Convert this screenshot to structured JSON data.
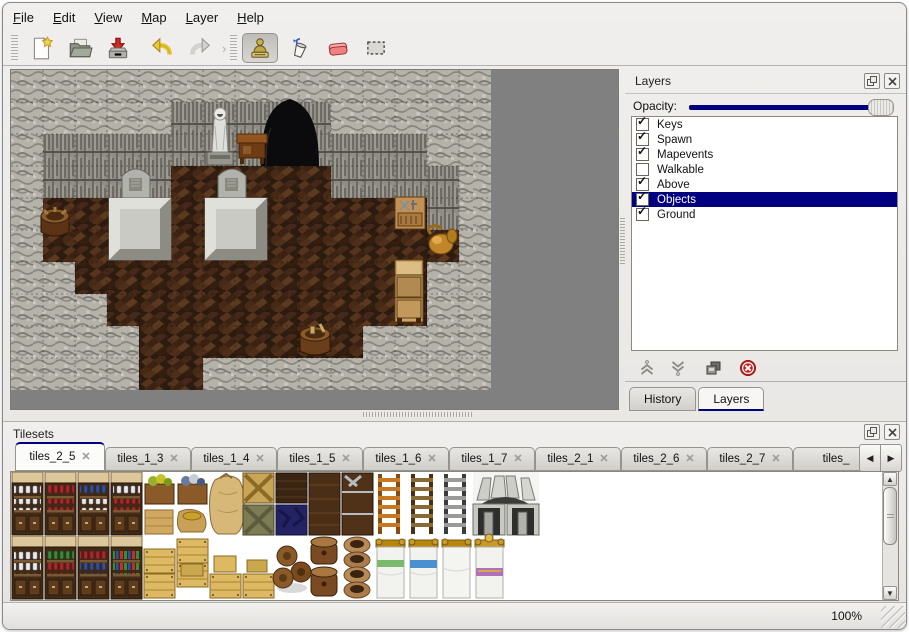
{
  "menu": {
    "items": [
      {
        "first": "F",
        "rest": "ile"
      },
      {
        "first": "E",
        "rest": "dit"
      },
      {
        "first": "V",
        "rest": "iew"
      },
      {
        "first": "M",
        "rest": "ap"
      },
      {
        "first": "L",
        "rest": "ayer"
      },
      {
        "first": "H",
        "rest": "elp"
      }
    ]
  },
  "toolbar": {
    "icons": [
      "new-file",
      "open-file",
      "save-file",
      "undo",
      "redo",
      "stamp-tool",
      "fill-tool",
      "eraser-tool",
      "select-tool"
    ],
    "active_tool": "stamp-tool"
  },
  "map": {
    "backdrop_color": "#808080",
    "tile_size_px": 32,
    "visible_map_tiles": "15x10"
  },
  "layers_panel": {
    "title": "Layers",
    "opacity_label": "Opacity:",
    "opacity_percent": 100,
    "items": [
      {
        "label": "Keys",
        "check": "✓"
      },
      {
        "label": "Spawn",
        "check": "✓"
      },
      {
        "label": "Mapevents",
        "check": "✓"
      },
      {
        "label": "Walkable",
        "check": ""
      },
      {
        "label": "Above",
        "check": "✓"
      },
      {
        "label": "Objects",
        "check": "✓",
        "selected": true
      },
      {
        "label": "Ground",
        "check": "✓"
      }
    ],
    "tabs": [
      {
        "label": "History",
        "active": false
      },
      {
        "label": "Layers",
        "active": true
      }
    ]
  },
  "tilesets_panel": {
    "title": "Tilesets",
    "active_tab": "tiles_2_5",
    "tabs": [
      {
        "label": "tiles_2_5",
        "active": true
      },
      {
        "label": "tiles_1_3"
      },
      {
        "label": "tiles_1_4"
      },
      {
        "label": "tiles_1_5"
      },
      {
        "label": "tiles_1_6"
      },
      {
        "label": "tiles_1_7"
      },
      {
        "label": "tiles_2_1"
      },
      {
        "label": "tiles_2_6"
      },
      {
        "label": "tiles_2_7"
      },
      {
        "label": "tiles_"
      }
    ]
  },
  "status_bar": {
    "zoom": "100%"
  },
  "icons": {
    "close": "✕",
    "float": "❐",
    "check": "✓",
    "tab_close": "✕",
    "scroll_left": "◀",
    "scroll_right": "▶",
    "scroll_up": "▲",
    "scroll_down": "▼",
    "overflow_chevron": "›"
  },
  "colors": {
    "selection": "#000080",
    "accent": "#00007f",
    "map_backdrop": "#808080",
    "chrome": "#e8e6e3"
  }
}
